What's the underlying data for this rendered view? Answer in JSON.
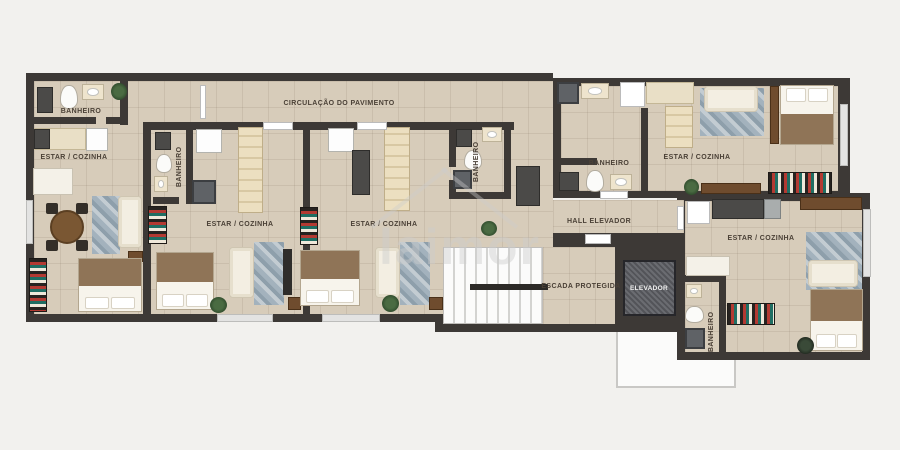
{
  "plan": {
    "corridor_label": "CIRCULAÇÃO DO PAVIMENTO",
    "hall_label": "HALL ELEVADOR",
    "stairs_label": "ESCADA PROTEGIDA",
    "elevator_label": "ELEVADOR",
    "watermark": "laimor"
  },
  "units": [
    {
      "id": "unit-a",
      "bathroom_label": "BANHEIRO",
      "living_label": "ESTAR / COZINHA"
    },
    {
      "id": "unit-b",
      "bathroom_label": "BANHEIRO",
      "living_label": "ESTAR / COZINHA"
    },
    {
      "id": "unit-c",
      "bathroom_label": "BANHEIRO",
      "living_label": "ESTAR / COZINHA"
    },
    {
      "id": "unit-d",
      "bathroom_label": "BANHEIRO",
      "living_label": "ESTAR / COZINHA"
    },
    {
      "id": "unit-e",
      "bathroom_label": "BANHEIRO",
      "living_label": "ESTAR / COZINHA"
    }
  ],
  "colors": {
    "background": "#f2f1ee",
    "wall": "#3d3936",
    "floor": "#d7ccba",
    "stairs": "#fbfbfb",
    "elevator_cab": "#5e6065",
    "rug_blue": "#a3b2bd",
    "wood_brown": "#6f4c2e",
    "label_text": "#4b4137"
  },
  "furniture": [
    {
      "name": "washing-machine",
      "type": "appliance-dark",
      "x": 37,
      "y": 87,
      "w": 16,
      "h": 26
    },
    {
      "name": "toilet",
      "type": "toilet",
      "x": 60,
      "y": 85,
      "w": 18,
      "h": 24
    },
    {
      "name": "sink-vanity",
      "type": "vanity",
      "x": 82,
      "y": 84,
      "w": 22,
      "h": 16
    },
    {
      "name": "plant",
      "type": "plant",
      "x": 111,
      "y": 83,
      "w": 16,
      "h": 17
    },
    {
      "name": "kitchen-counter",
      "type": "counter",
      "x": 34,
      "y": 128,
      "w": 52,
      "h": 22
    },
    {
      "name": "stove",
      "type": "appliance-dark",
      "x": 34,
      "y": 129,
      "w": 16,
      "h": 20
    },
    {
      "name": "fridge",
      "type": "fridge",
      "x": 86,
      "y": 128,
      "w": 22,
      "h": 23
    },
    {
      "name": "desk",
      "type": "table-white",
      "x": 33,
      "y": 168,
      "w": 40,
      "h": 27
    },
    {
      "name": "dining-table",
      "type": "dining",
      "x": 50,
      "y": 210,
      "w": 34,
      "h": 34
    },
    {
      "name": "chair",
      "type": "chair",
      "x": 46,
      "y": 203,
      "w": 12,
      "h": 11
    },
    {
      "name": "chair",
      "type": "chair",
      "x": 76,
      "y": 203,
      "w": 12,
      "h": 11
    },
    {
      "name": "chair",
      "type": "chair",
      "x": 46,
      "y": 240,
      "w": 12,
      "h": 11
    },
    {
      "name": "chair",
      "type": "chair",
      "x": 76,
      "y": 240,
      "w": 12,
      "h": 11
    },
    {
      "name": "rug",
      "type": "rug",
      "x": 92,
      "y": 196,
      "w": 28,
      "h": 58
    },
    {
      "name": "sofa",
      "type": "sofa-v",
      "x": 118,
      "y": 196,
      "w": 24,
      "h": 52
    },
    {
      "name": "side-table",
      "type": "wood",
      "x": 128,
      "y": 251,
      "w": 15,
      "h": 11
    },
    {
      "name": "double-bed",
      "type": "bed-s",
      "x": 78,
      "y": 258,
      "w": 64,
      "h": 54
    },
    {
      "name": "bookshelf",
      "type": "bookshelf-v",
      "x": 29,
      "y": 258,
      "w": 18,
      "h": 54
    },
    {
      "name": "washing-machine",
      "type": "appliance-dark",
      "x": 155,
      "y": 132,
      "w": 16,
      "h": 18
    },
    {
      "name": "fridge",
      "type": "fridge",
      "x": 196,
      "y": 129,
      "w": 26,
      "h": 24
    },
    {
      "name": "toilet",
      "type": "toilet",
      "x": 156,
      "y": 154,
      "w": 16,
      "h": 19
    },
    {
      "name": "sink-vanity",
      "type": "vanity",
      "x": 154,
      "y": 176,
      "w": 14,
      "h": 16
    },
    {
      "name": "shower",
      "type": "shower",
      "x": 192,
      "y": 180,
      "w": 24,
      "h": 24
    },
    {
      "name": "kitchen-cabinets",
      "type": "cabinet-col",
      "x": 238,
      "y": 127,
      "w": 25,
      "h": 86
    },
    {
      "name": "bookshelf",
      "type": "bookshelf-v",
      "x": 148,
      "y": 206,
      "w": 19,
      "h": 38
    },
    {
      "name": "double-bed",
      "type": "bed-s",
      "x": 156,
      "y": 252,
      "w": 58,
      "h": 58
    },
    {
      "name": "sofa",
      "type": "sofa-v",
      "x": 229,
      "y": 247,
      "w": 25,
      "h": 51
    },
    {
      "name": "rug",
      "type": "rug",
      "x": 254,
      "y": 242,
      "w": 30,
      "h": 63
    },
    {
      "name": "tv-panel",
      "type": "tv-dark",
      "x": 283,
      "y": 249,
      "w": 9,
      "h": 46
    },
    {
      "name": "plant",
      "type": "plant",
      "x": 210,
      "y": 297,
      "w": 17,
      "h": 16
    },
    {
      "name": "side-table",
      "type": "wood",
      "x": 288,
      "y": 297,
      "w": 13,
      "h": 13
    },
    {
      "name": "fridge",
      "type": "fridge",
      "x": 328,
      "y": 128,
      "w": 26,
      "h": 24
    },
    {
      "name": "kitchen-sink-counter",
      "type": "appliance-dark",
      "x": 352,
      "y": 150,
      "w": 18,
      "h": 45
    },
    {
      "name": "kitchen-cabinets",
      "type": "cabinet-col",
      "x": 384,
      "y": 127,
      "w": 26,
      "h": 84
    },
    {
      "name": "washing-machine",
      "type": "appliance-dark",
      "x": 456,
      "y": 129,
      "w": 16,
      "h": 18
    },
    {
      "name": "sink-vanity",
      "type": "vanity",
      "x": 482,
      "y": 127,
      "w": 20,
      "h": 15
    },
    {
      "name": "toilet",
      "type": "toilet",
      "x": 464,
      "y": 150,
      "w": 18,
      "h": 20
    },
    {
      "name": "shower",
      "type": "shower",
      "x": 453,
      "y": 170,
      "w": 19,
      "h": 19
    },
    {
      "name": "utility-cabinet",
      "type": "appliance-dark",
      "x": 516,
      "y": 166,
      "w": 24,
      "h": 40
    },
    {
      "name": "bookshelf",
      "type": "bookshelf-v",
      "x": 300,
      "y": 207,
      "w": 18,
      "h": 38
    },
    {
      "name": "double-bed",
      "type": "bed-s",
      "x": 300,
      "y": 250,
      "w": 60,
      "h": 56
    },
    {
      "name": "sofa",
      "type": "sofa-v",
      "x": 375,
      "y": 247,
      "w": 25,
      "h": 51
    },
    {
      "name": "rug",
      "type": "rug",
      "x": 400,
      "y": 242,
      "w": 30,
      "h": 63
    },
    {
      "name": "plant",
      "type": "plant",
      "x": 382,
      "y": 295,
      "w": 17,
      "h": 17
    },
    {
      "name": "side-table",
      "type": "wood",
      "x": 429,
      "y": 297,
      "w": 14,
      "h": 13
    },
    {
      "name": "plant",
      "type": "plant",
      "x": 481,
      "y": 221,
      "w": 16,
      "h": 15
    },
    {
      "name": "shower",
      "type": "shower",
      "x": 557,
      "y": 82,
      "w": 22,
      "h": 22
    },
    {
      "name": "sink-vanity",
      "type": "vanity",
      "x": 581,
      "y": 83,
      "w": 28,
      "h": 16
    },
    {
      "name": "door-leaf",
      "type": "door",
      "x": 620,
      "y": 82,
      "w": 25,
      "h": 25
    },
    {
      "name": "kitchen-counter",
      "type": "counter",
      "x": 646,
      "y": 82,
      "w": 48,
      "h": 22
    },
    {
      "name": "kitchen-cabinets",
      "type": "cabinet-col",
      "x": 665,
      "y": 106,
      "w": 28,
      "h": 42
    },
    {
      "name": "washing-machine",
      "type": "appliance-dark",
      "x": 559,
      "y": 172,
      "w": 20,
      "h": 19
    },
    {
      "name": "toilet",
      "type": "toilet",
      "x": 586,
      "y": 170,
      "w": 18,
      "h": 22
    },
    {
      "name": "sink-vanity",
      "type": "vanity",
      "x": 610,
      "y": 174,
      "w": 22,
      "h": 16
    },
    {
      "name": "rug",
      "type": "rug",
      "x": 700,
      "y": 88,
      "w": 64,
      "h": 48
    },
    {
      "name": "sofa",
      "type": "sofa-h",
      "x": 704,
      "y": 86,
      "w": 54,
      "h": 26
    },
    {
      "name": "bed-bench",
      "type": "wood",
      "x": 770,
      "y": 86,
      "w": 9,
      "h": 58
    },
    {
      "name": "double-bed",
      "type": "bed-n",
      "x": 780,
      "y": 85,
      "w": 54,
      "h": 60
    },
    {
      "name": "plant",
      "type": "plant",
      "x": 684,
      "y": 179,
      "w": 15,
      "h": 16
    },
    {
      "name": "tv-sideboard",
      "type": "wood",
      "x": 701,
      "y": 183,
      "w": 60,
      "h": 11
    },
    {
      "name": "bookshelf",
      "type": "bookshelf-h",
      "x": 768,
      "y": 172,
      "w": 64,
      "h": 22
    },
    {
      "name": "window",
      "type": "window-v",
      "x": 840,
      "y": 104,
      "w": 8,
      "h": 62
    },
    {
      "name": "door-leaf",
      "type": "door",
      "x": 687,
      "y": 201,
      "w": 23,
      "h": 23
    },
    {
      "name": "kitchen-sink-counter",
      "type": "appliance-dark",
      "x": 712,
      "y": 199,
      "w": 52,
      "h": 20
    },
    {
      "name": "fridge",
      "type": "appliance-steel",
      "x": 764,
      "y": 199,
      "w": 17,
      "h": 20
    },
    {
      "name": "tv-sideboard",
      "type": "wood",
      "x": 800,
      "y": 197,
      "w": 62,
      "h": 13
    },
    {
      "name": "cabinet",
      "type": "table-white",
      "x": 686,
      "y": 256,
      "w": 44,
      "h": 20
    },
    {
      "name": "bookshelf",
      "type": "bookshelf-h",
      "x": 727,
      "y": 303,
      "w": 48,
      "h": 22
    },
    {
      "name": "rug",
      "type": "rug",
      "x": 806,
      "y": 232,
      "w": 56,
      "h": 58
    },
    {
      "name": "sofa",
      "type": "sofa-h",
      "x": 808,
      "y": 260,
      "w": 50,
      "h": 27
    },
    {
      "name": "double-bed",
      "type": "bed-s",
      "x": 810,
      "y": 289,
      "w": 53,
      "h": 62
    },
    {
      "name": "sink-vanity",
      "type": "vanity",
      "x": 686,
      "y": 284,
      "w": 16,
      "h": 14
    },
    {
      "name": "toilet",
      "type": "toilet",
      "x": 685,
      "y": 306,
      "w": 19,
      "h": 17
    },
    {
      "name": "shower",
      "type": "shower",
      "x": 685,
      "y": 328,
      "w": 20,
      "h": 21
    },
    {
      "name": "plant",
      "type": "plant-dark",
      "x": 797,
      "y": 337,
      "w": 17,
      "h": 17
    },
    {
      "name": "window",
      "type": "window-v",
      "x": 863,
      "y": 209,
      "w": 8,
      "h": 68
    },
    {
      "name": "window",
      "type": "window-h",
      "x": 217,
      "y": 314,
      "w": 56,
      "h": 8
    },
    {
      "name": "window",
      "type": "window-h",
      "x": 322,
      "y": 314,
      "w": 58,
      "h": 8
    },
    {
      "name": "window",
      "type": "window-v",
      "x": 26,
      "y": 200,
      "w": 7,
      "h": 44
    },
    {
      "name": "door-threshold",
      "type": "door",
      "x": 263,
      "y": 122,
      "w": 30,
      "h": 8
    },
    {
      "name": "door-threshold",
      "type": "door",
      "x": 357,
      "y": 122,
      "w": 30,
      "h": 8
    },
    {
      "name": "door-threshold",
      "type": "door",
      "x": 585,
      "y": 234,
      "w": 26,
      "h": 10
    },
    {
      "name": "door-threshold",
      "type": "door",
      "x": 600,
      "y": 191,
      "w": 28,
      "h": 8
    },
    {
      "name": "door-threshold",
      "type": "door",
      "x": 677,
      "y": 206,
      "w": 7,
      "h": 24
    },
    {
      "name": "door-leaf",
      "type": "door",
      "x": 200,
      "y": 85,
      "w": 6,
      "h": 34
    },
    {
      "name": "stair-rail",
      "type": "rail",
      "x": 470,
      "y": 284,
      "w": 78,
      "h": 6
    }
  ]
}
